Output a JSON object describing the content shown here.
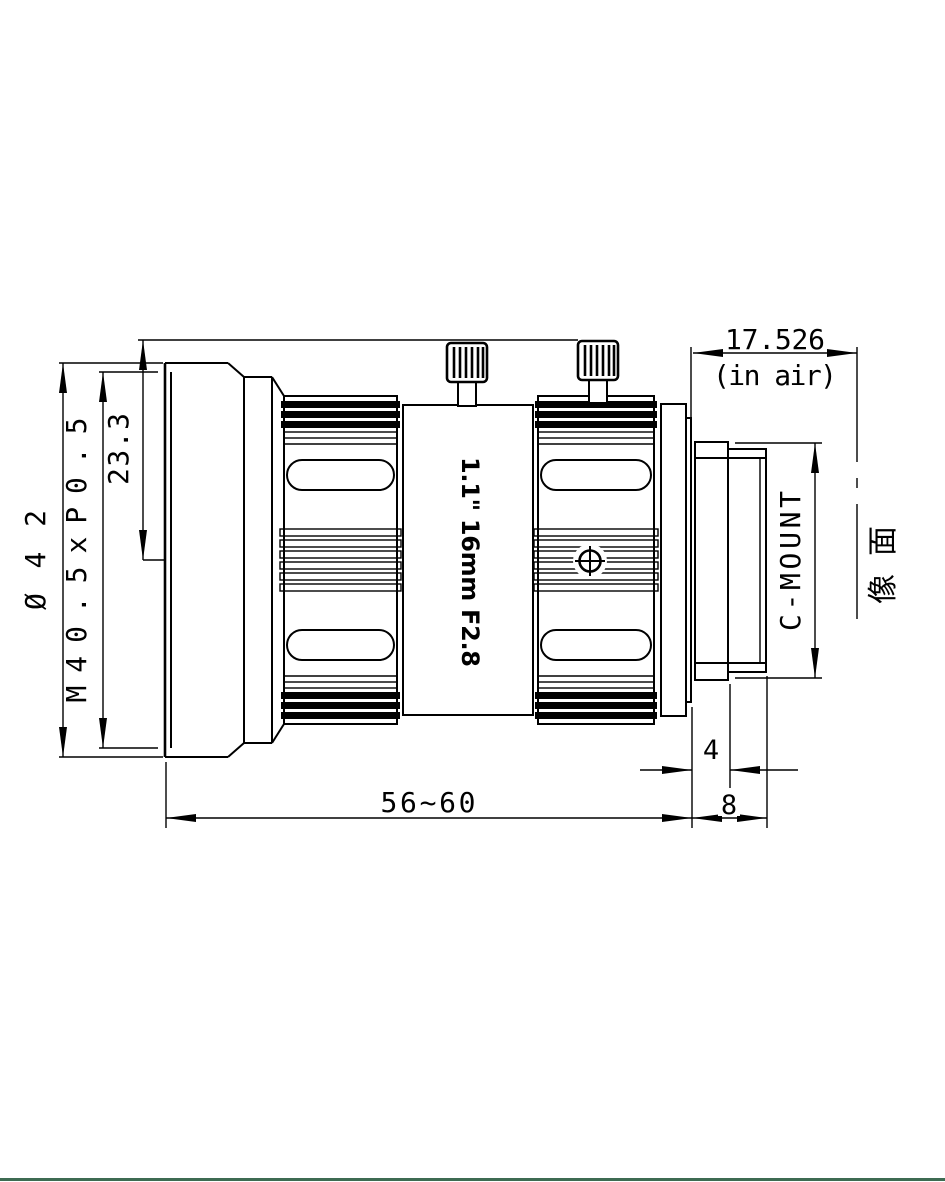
{
  "drawing": {
    "title": "C-mount lens mechanical drawing",
    "labels": {
      "diameter_outer": "Ø42",
      "front_thread": "M40.5xP0.5",
      "screw_radius": "23.3",
      "length_range": "56~60",
      "flange_back": "17.526",
      "flange_back_note": "(in air)",
      "mount_type": "C-MOUNT",
      "image_plane": "像面",
      "dim_rear_step": "4",
      "dim_mount_length": "8",
      "lens_marking": "1.1\" 16mm F2.8"
    },
    "colors": {
      "line": "#000000",
      "background": "#ffffff",
      "footer_bar": "#3e6b52"
    }
  }
}
